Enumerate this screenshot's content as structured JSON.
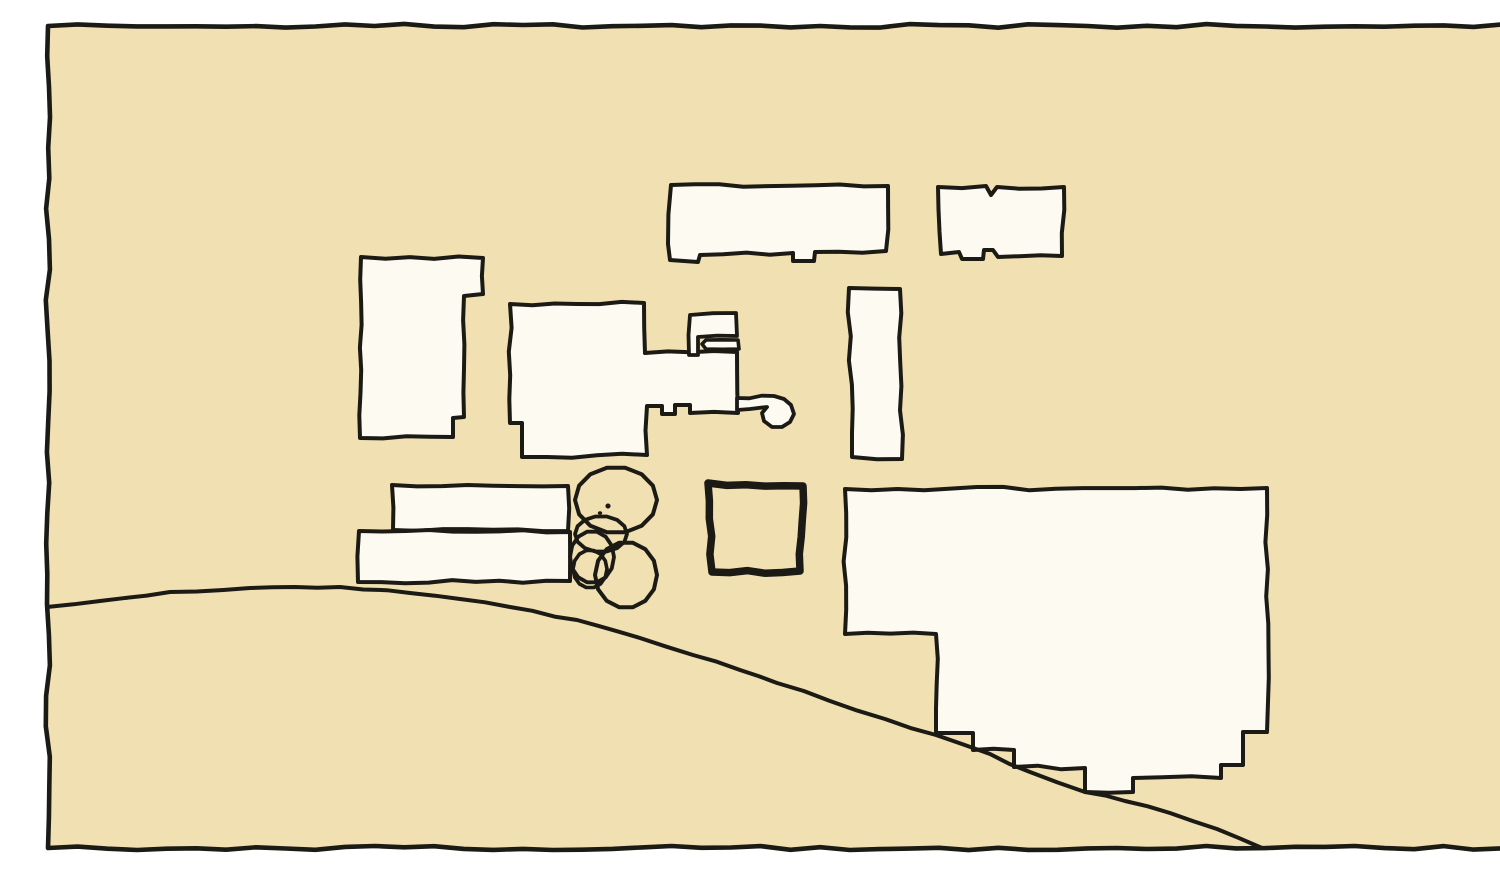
{
  "canvas": {
    "width": 1500,
    "height": 844,
    "margin_color": "#ffffff",
    "paper_color": "#f0e0b2",
    "building_fill_color": "#fcfaf1",
    "ink_color": "#1c1a15"
  },
  "legend": {
    "description": "hand-drawn site plan sketch: building footprints, terraces, tree, plaza square, curved road, wobbly border frame"
  },
  "shapes": [
    {
      "name": "border-frame",
      "type": "polygon",
      "fill": "paper",
      "sw": 4.6,
      "amp": 2.2,
      "step": 30,
      "points": [
        [
          8,
          10
        ],
        [
          1493,
          10
        ],
        [
          1493,
          832
        ],
        [
          8,
          832
        ]
      ]
    },
    {
      "name": "building-left-tall",
      "type": "polygon",
      "fill": "building",
      "sw": 4,
      "amp": 1.7,
      "step": 24,
      "points": [
        [
          321,
          241
        ],
        [
          443,
          242
        ],
        [
          443,
          278
        ],
        [
          424,
          280
        ],
        [
          424,
          401
        ],
        [
          413,
          402
        ],
        [
          413,
          421
        ],
        [
          320,
          422
        ]
      ]
    },
    {
      "name": "building-top-long",
      "type": "polygon",
      "fill": "building",
      "sw": 4,
      "amp": 1.7,
      "step": 24,
      "points": [
        [
          631,
          169
        ],
        [
          848,
          170
        ],
        [
          846,
          235
        ],
        [
          775,
          236
        ],
        [
          774,
          245
        ],
        [
          753,
          245
        ],
        [
          753,
          237
        ],
        [
          660,
          239
        ],
        [
          658,
          246
        ],
        [
          630,
          244
        ],
        [
          628,
          228
        ]
      ]
    },
    {
      "name": "building-top-right",
      "type": "polygon",
      "fill": "building",
      "sw": 4,
      "amp": 1.7,
      "step": 24,
      "points": [
        [
          898,
          171
        ],
        [
          946,
          170
        ],
        [
          951,
          179
        ],
        [
          957,
          171
        ],
        [
          1024,
          171
        ],
        [
          1022,
          240
        ],
        [
          958,
          241
        ],
        [
          953,
          234
        ],
        [
          944,
          234
        ],
        [
          943,
          243
        ],
        [
          922,
          243
        ],
        [
          919,
          236
        ],
        [
          901,
          238
        ]
      ]
    },
    {
      "name": "building-vertical-bar",
      "type": "polygon",
      "fill": "building",
      "sw": 4,
      "amp": 1.6,
      "step": 24,
      "points": [
        [
          809,
          272
        ],
        [
          860,
          273
        ],
        [
          862,
          443
        ],
        [
          812,
          441
        ]
      ]
    },
    {
      "name": "building-central-main",
      "type": "polygon",
      "fill": "building",
      "sw": 4,
      "amp": 1.7,
      "step": 24,
      "points": [
        [
          470,
          288
        ],
        [
          604,
          287
        ],
        [
          605,
          337
        ],
        [
          697,
          336
        ],
        [
          698,
          397
        ],
        [
          650,
          397
        ],
        [
          650,
          389
        ],
        [
          635,
          389
        ],
        [
          635,
          398
        ],
        [
          622,
          398
        ],
        [
          622,
          390
        ],
        [
          607,
          390
        ],
        [
          607,
          439
        ],
        [
          482,
          441
        ],
        [
          482,
          407
        ],
        [
          470,
          407
        ]
      ]
    },
    {
      "name": "building-central-annex",
      "type": "polygon",
      "fill": "building",
      "sw": 3.8,
      "amp": 1.3,
      "step": 20,
      "points": [
        [
          650,
          299
        ],
        [
          696,
          297
        ],
        [
          697,
          320
        ],
        [
          658,
          321
        ],
        [
          658,
          339
        ],
        [
          649,
          339
        ]
      ]
    },
    {
      "name": "building-central-wing-bar",
      "type": "polygon",
      "fill": "building",
      "sw": 3.6,
      "amp": 1.0,
      "step": 16,
      "points": [
        [
          666,
          324
        ],
        [
          698,
          324
        ],
        [
          699,
          333
        ],
        [
          666,
          333
        ],
        [
          662,
          328
        ]
      ]
    },
    {
      "name": "building-central-key-arm",
      "type": "polygon",
      "fill": "building",
      "sw": 3.8,
      "amp": 1.1,
      "step": 14,
      "points": [
        [
          697,
          382
        ],
        [
          734,
          380
        ],
        [
          744,
          383
        ],
        [
          751,
          389
        ],
        [
          754,
          398
        ],
        [
          750,
          406
        ],
        [
          742,
          411
        ],
        [
          732,
          411
        ],
        [
          724,
          405
        ],
        [
          722,
          397
        ],
        [
          727,
          391
        ],
        [
          710,
          393
        ],
        [
          697,
          394
        ]
      ]
    },
    {
      "name": "terrace-step-upper",
      "type": "polygon",
      "fill": "building",
      "sw": 4,
      "amp": 1.6,
      "step": 24,
      "points": [
        [
          352,
          469
        ],
        [
          528,
          470
        ],
        [
          528,
          515
        ],
        [
          353,
          514
        ]
      ]
    },
    {
      "name": "terrace-step-lower",
      "type": "polygon",
      "fill": "building",
      "sw": 4,
      "amp": 1.6,
      "step": 24,
      "points": [
        [
          319,
          515
        ],
        [
          530,
          516
        ],
        [
          530,
          565
        ],
        [
          318,
          566
        ]
      ]
    },
    {
      "name": "building-right-big",
      "type": "polygon",
      "fill": "building",
      "sw": 4,
      "amp": 1.8,
      "step": 26,
      "points": [
        [
          805,
          473
        ],
        [
          1227,
          472
        ],
        [
          1227,
          716
        ],
        [
          1203,
          716
        ],
        [
          1203,
          749
        ],
        [
          1181,
          749
        ],
        [
          1181,
          762
        ],
        [
          1093,
          762
        ],
        [
          1093,
          776
        ],
        [
          1045,
          776
        ],
        [
          1045,
          752
        ],
        [
          974,
          751
        ],
        [
          974,
          734
        ],
        [
          933,
          734
        ],
        [
          933,
          717
        ],
        [
          896,
          717
        ],
        [
          896,
          618
        ],
        [
          805,
          618
        ]
      ]
    },
    {
      "name": "tree-canopy-top-cloud",
      "type": "ellipse",
      "fill": "none",
      "sw": 4,
      "amp": 2.8,
      "step": 16,
      "cx": 576,
      "cy": 484,
      "rx": 41,
      "ry": 33
    },
    {
      "name": "tree-canopy-mid-blob",
      "type": "ellipse",
      "fill": "none",
      "sw": 3.8,
      "amp": 2.4,
      "step": 14,
      "cx": 561,
      "cy": 518,
      "rx": 26,
      "ry": 18
    },
    {
      "name": "tree-canopy-left-circle",
      "type": "ellipse",
      "fill": "none",
      "sw": 3.8,
      "amp": 1.8,
      "step": 14,
      "cx": 552,
      "cy": 541,
      "rx": 22,
      "ry": 26
    },
    {
      "name": "tree-canopy-inner-circle",
      "type": "ellipse",
      "fill": "none",
      "sw": 3.6,
      "amp": 1.4,
      "step": 12,
      "cx": 550,
      "cy": 553,
      "rx": 17,
      "ry": 19
    },
    {
      "name": "tree-canopy-right-circle",
      "type": "ellipse",
      "fill": "none",
      "sw": 4,
      "amp": 2.0,
      "step": 15,
      "cx": 586,
      "cy": 559,
      "rx": 31,
      "ry": 33
    },
    {
      "name": "tree-trunk-dot",
      "type": "dot",
      "fill": "ink",
      "sw": 0,
      "cx": 568,
      "cy": 490,
      "rx": 2.6,
      "ry": 2.6
    },
    {
      "name": "tree-trunk-dash",
      "type": "dot",
      "fill": "ink",
      "sw": 0,
      "cx": 560,
      "cy": 497,
      "rx": 2.2,
      "ry": 1.8
    },
    {
      "name": "plaza-square",
      "type": "polygon",
      "fill": "none",
      "sw": 7.5,
      "amp": 1.8,
      "step": 18,
      "points": [
        [
          668,
          467
        ],
        [
          763,
          470
        ],
        [
          760,
          555
        ],
        [
          672,
          556
        ]
      ]
    },
    {
      "name": "road-line",
      "type": "polyline",
      "fill": "none",
      "sw": 4,
      "amp": 1.1,
      "step": 24,
      "points": [
        [
          7,
          591
        ],
        [
          60,
          585
        ],
        [
          130,
          576
        ],
        [
          210,
          572
        ],
        [
          300,
          571
        ],
        [
          370,
          577
        ],
        [
          420,
          583
        ],
        [
          470,
          591
        ],
        [
          537,
          604
        ],
        [
          600,
          622
        ],
        [
          653,
          639
        ],
        [
          700,
          654
        ],
        [
          737,
          667
        ],
        [
          790,
          685
        ],
        [
          845,
          703
        ],
        [
          896,
          719
        ],
        [
          950,
          738
        ],
        [
          990,
          756
        ],
        [
          1045,
          776
        ],
        [
          1085,
          785
        ],
        [
          1130,
          797
        ],
        [
          1177,
          813
        ],
        [
          1222,
          832
        ]
      ]
    }
  ]
}
